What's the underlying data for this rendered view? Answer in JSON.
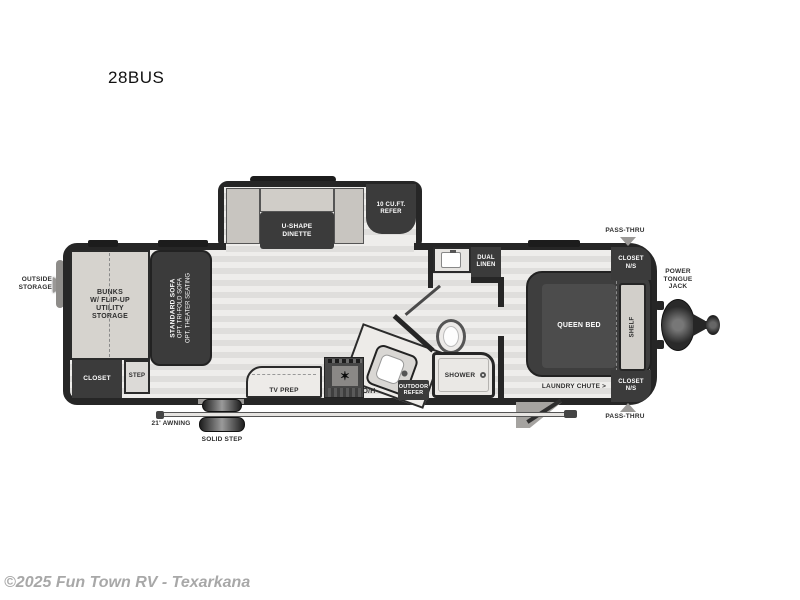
{
  "page": {
    "title": "28BUS",
    "copyright": "©2025 Fun Town RV - Texarkana"
  },
  "labels": {
    "outside_storage": "OUTSIDE\nSTORAGE",
    "bunks": "BUNKS\nW/ FLIP-UP\nUTILITY\nSTORAGE",
    "sofa1": "STANDARD SOFA",
    "sofa2": "OPT. TRI-FOLD SOFA",
    "sofa3": "OPT. THEATER SEATING",
    "closet": "CLOSET",
    "step": "STEP",
    "dinette": "U-SHAPE\nDINETTE",
    "refer": "10 CU.FT.\nREFER",
    "tv_prep": "TV PREP",
    "oh": "O/H",
    "outdoor_refer": "OUTDOOR\nREFER",
    "shower": "SHOWER",
    "dual_linen": "DUAL\nLINEN",
    "queen_bed": "QUEEN BED",
    "shelf": "SHELF",
    "closet_ns": "CLOSET\nN/S",
    "pass_thru": "PASS-THRU",
    "power_tongue_jack": "POWER\nTONGUE\nJACK",
    "laundry_chute": "LAUNDRY CHUTE >",
    "awning": "21' AWNING",
    "solid_step": "SOLID STEP",
    "stove_burner_icon": "✶"
  },
  "colors": {
    "wall": "#262626",
    "furniture": "#3b3b3b",
    "floor": "#e9e8e6",
    "bunk_floor": "#d6d3ce",
    "arrow_gray": "#9a9896",
    "copyright_gray": "#a8a8a8"
  }
}
